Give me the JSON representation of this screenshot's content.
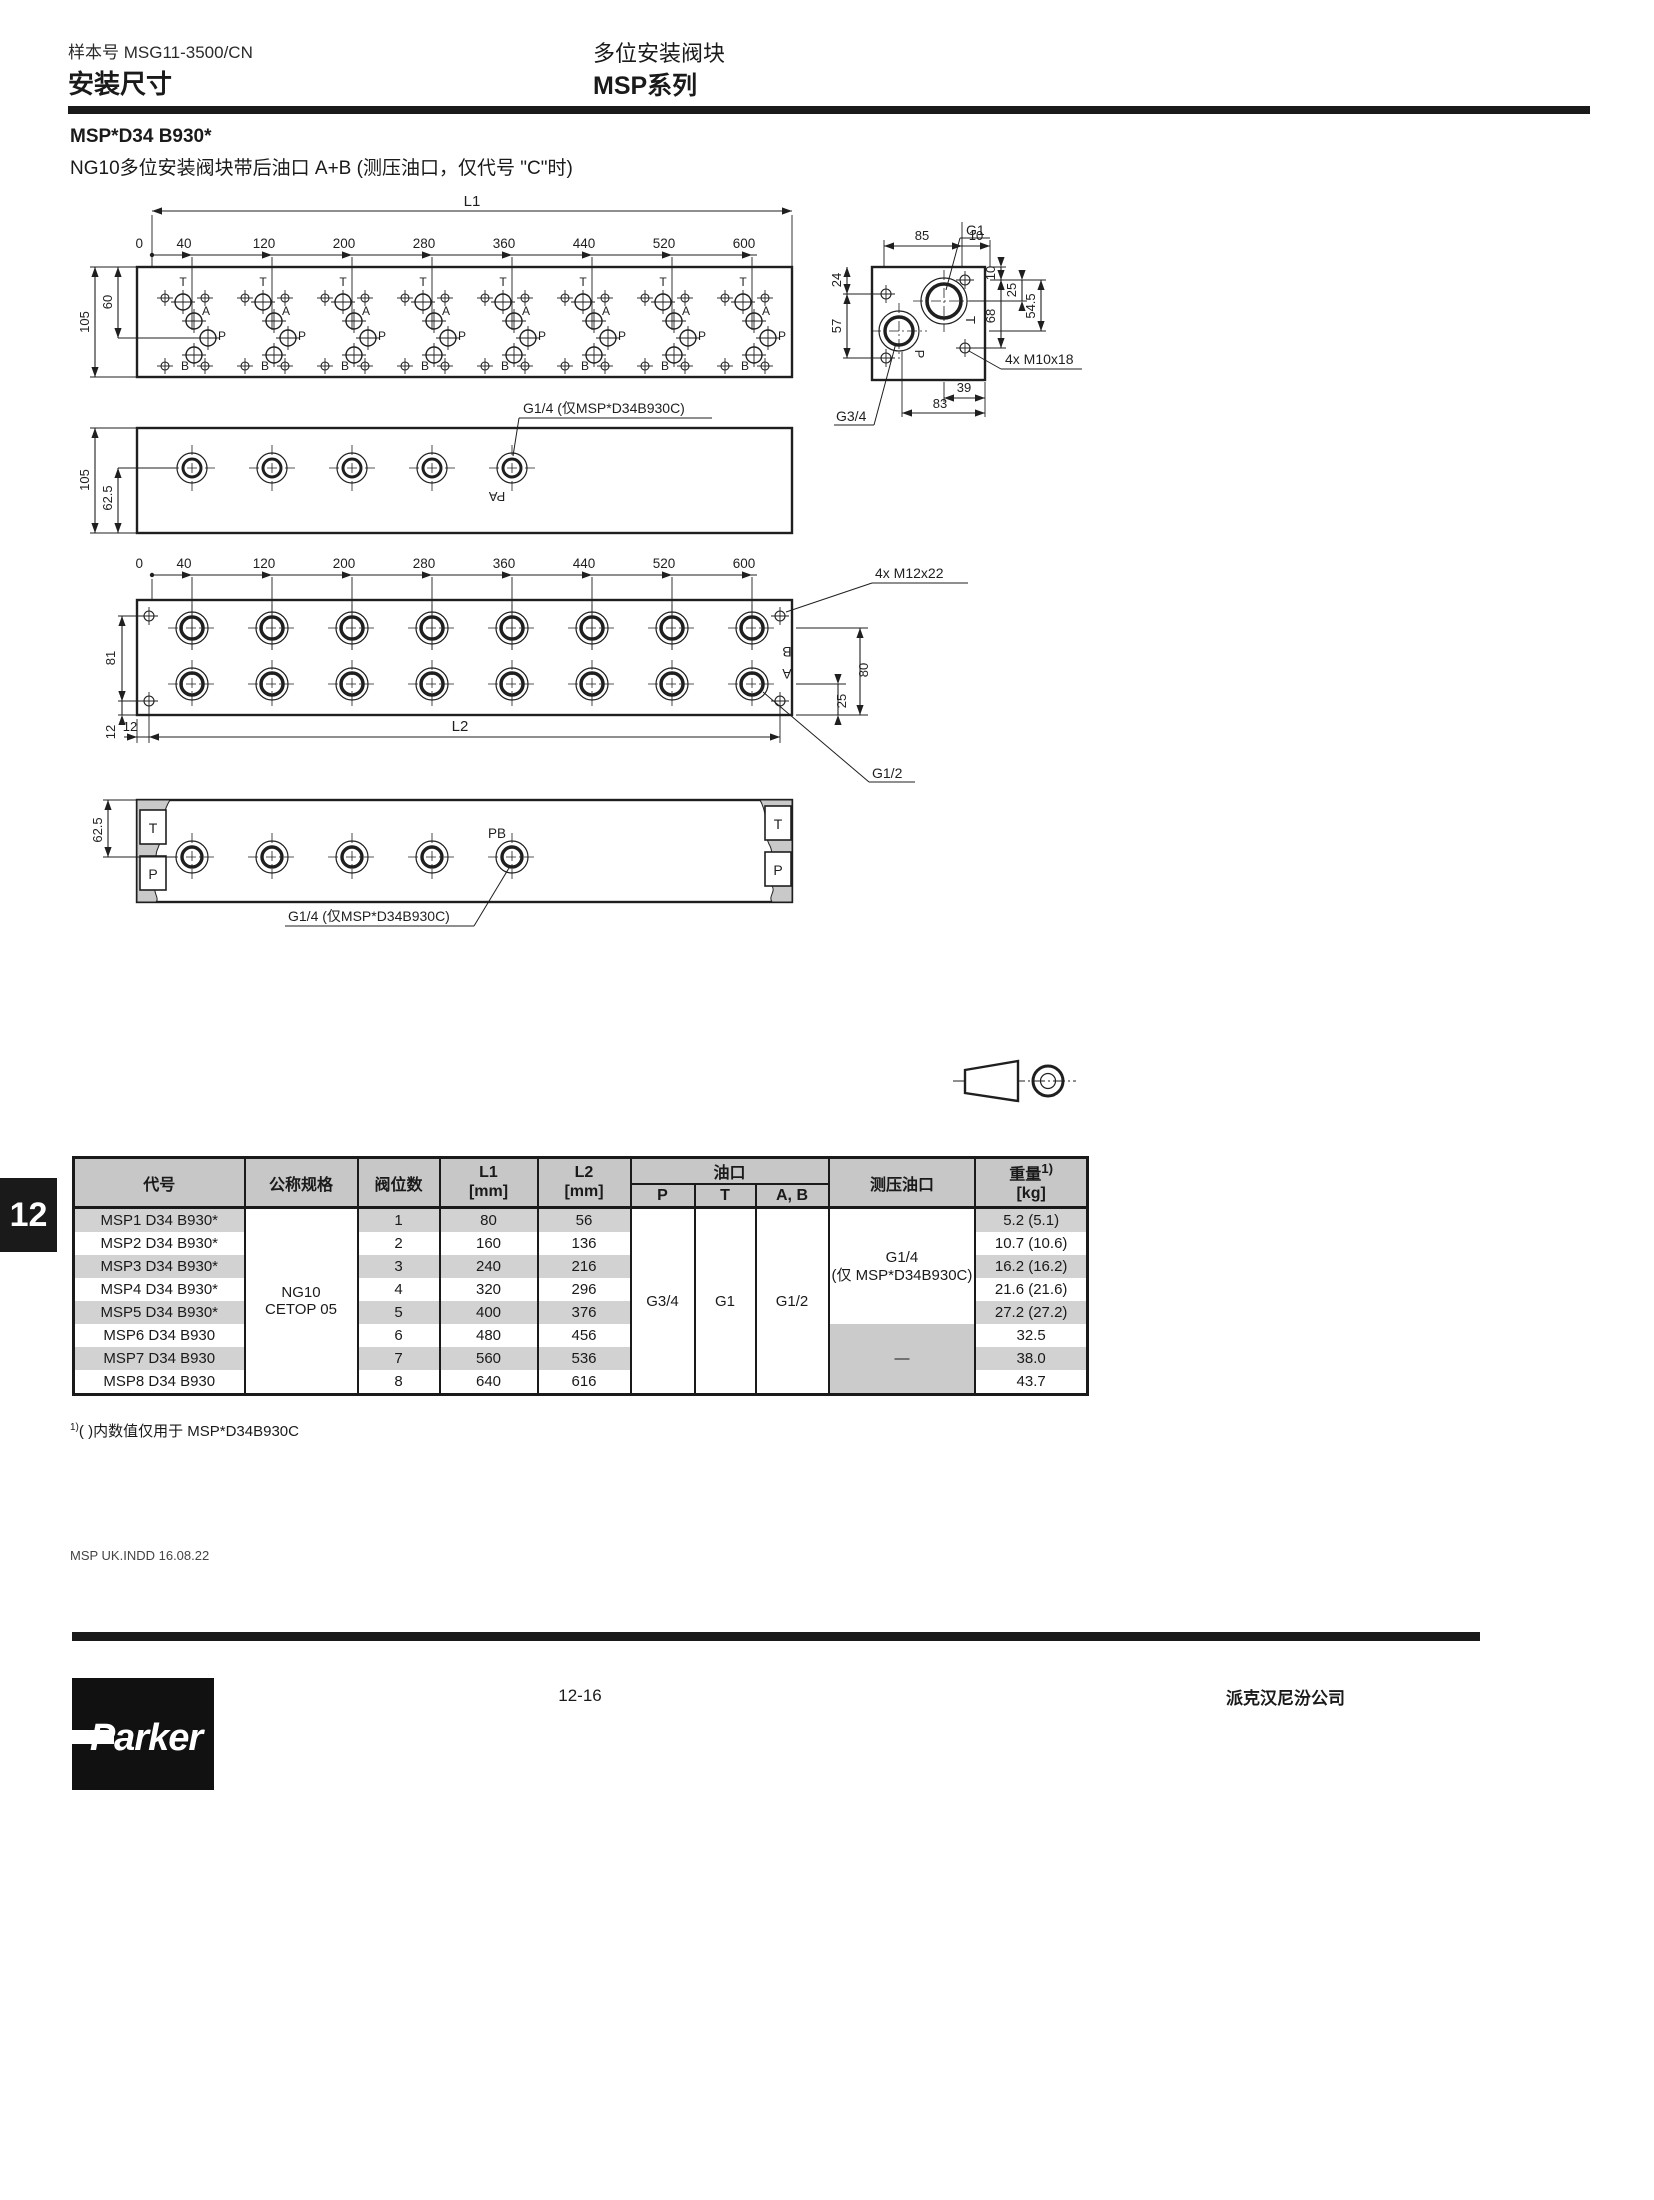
{
  "page": {
    "doc_number_label": "样本号  MSG11-3500/CN",
    "section_title": "安装尺寸",
    "product_title": "多位安装阀块",
    "series_title": "MSP系列",
    "chapter_tab": "12",
    "footnote_marker": "1)",
    "footnote": "( )内数值仅用于 MSP*D34B930C",
    "file_note": "MSP UK.INDD  16.08.22",
    "page_number": "12-16",
    "company": "派克汉尼汾公司",
    "logo_text": "Parker"
  },
  "section": {
    "model_title": "MSP*D34 B930*",
    "model_subtitle": "NG10多位安装阀块带后油口 A+B (测压油口，仅代号 \"C\"时)"
  },
  "drawing": {
    "l1_label": "L1",
    "l2_label": "L2",
    "zero_label": "0",
    "ticks": [
      "40",
      "120",
      "200",
      "280",
      "360",
      "440",
      "520",
      "600"
    ],
    "dims": {
      "d105": "105",
      "d60": "60",
      "d62_5": "62.5",
      "d81": "81",
      "d12": "12",
      "d80": "80",
      "d25": "25",
      "d24": "24",
      "d57": "57",
      "d85": "85",
      "d10": "10",
      "d68": "68",
      "d54_5": "54.5",
      "d39": "39",
      "d83": "83"
    },
    "labels": {
      "g1": "G1",
      "g34": "G3/4",
      "g12": "G1/2",
      "g14_note": "G1/4 (仅MSP*D34B930C)",
      "m10": "4x M10x18",
      "m12": "4x M12x22",
      "pa": "PA",
      "pb": "PB",
      "t": "T",
      "p": "P",
      "a": "A",
      "b": "B"
    }
  },
  "table": {
    "headers": {
      "code": "代号",
      "size": "公称规格",
      "positions": "阀位数",
      "l1": "L1",
      "l2": "L2",
      "mm": "[mm]",
      "ports": "油口",
      "p": "P",
      "t": "T",
      "ab": "A, B",
      "gauge": "测压油口",
      "weight": "重量",
      "weight_sup": "1)",
      "kg": "[kg]"
    },
    "size_value_1": "NG10",
    "size_value_2": "CETOP 05",
    "port_p": "G3/4",
    "port_t": "G1",
    "port_ab": "G1/2",
    "gauge_value_1": "G1/4",
    "gauge_value_2": "(仅 MSP*D34B930C)",
    "gauge_value_none": "—",
    "rows": [
      {
        "code": "MSP1 D34 B930*",
        "positions": "1",
        "l1": "80",
        "l2": "56",
        "weight": "5.2 (5.1)"
      },
      {
        "code": "MSP2 D34 B930*",
        "positions": "2",
        "l1": "160",
        "l2": "136",
        "weight": "10.7 (10.6)"
      },
      {
        "code": "MSP3 D34 B930*",
        "positions": "3",
        "l1": "240",
        "l2": "216",
        "weight": "16.2 (16.2)"
      },
      {
        "code": "MSP4 D34 B930*",
        "positions": "4",
        "l1": "320",
        "l2": "296",
        "weight": "21.6 (21.6)"
      },
      {
        "code": "MSP5 D34 B930*",
        "positions": "5",
        "l1": "400",
        "l2": "376",
        "weight": "27.2 (27.2)"
      },
      {
        "code": "MSP6 D34 B930",
        "positions": "6",
        "l1": "480",
        "l2": "456",
        "weight": "32.5"
      },
      {
        "code": "MSP7 D34 B930",
        "positions": "7",
        "l1": "560",
        "l2": "536",
        "weight": "38.0"
      },
      {
        "code": "MSP8 D34 B930",
        "positions": "8",
        "l1": "640",
        "l2": "616",
        "weight": "43.7"
      }
    ]
  }
}
